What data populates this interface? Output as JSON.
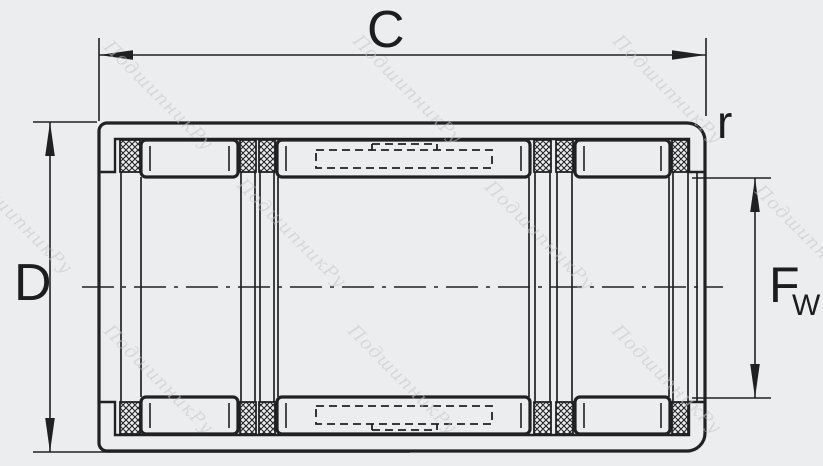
{
  "drawing": {
    "labels": {
      "overall_width": "C",
      "outside_diameter": "D",
      "corner_radius": "r",
      "bore_diameter_main": "F",
      "bore_diameter_sub": "W"
    },
    "watermark": {
      "text": "ПодшипникРу"
    },
    "colors": {
      "line": "#212124",
      "background": "#ecedef",
      "paper": "#ffffff",
      "watermark": "#c3c7cc"
    }
  }
}
